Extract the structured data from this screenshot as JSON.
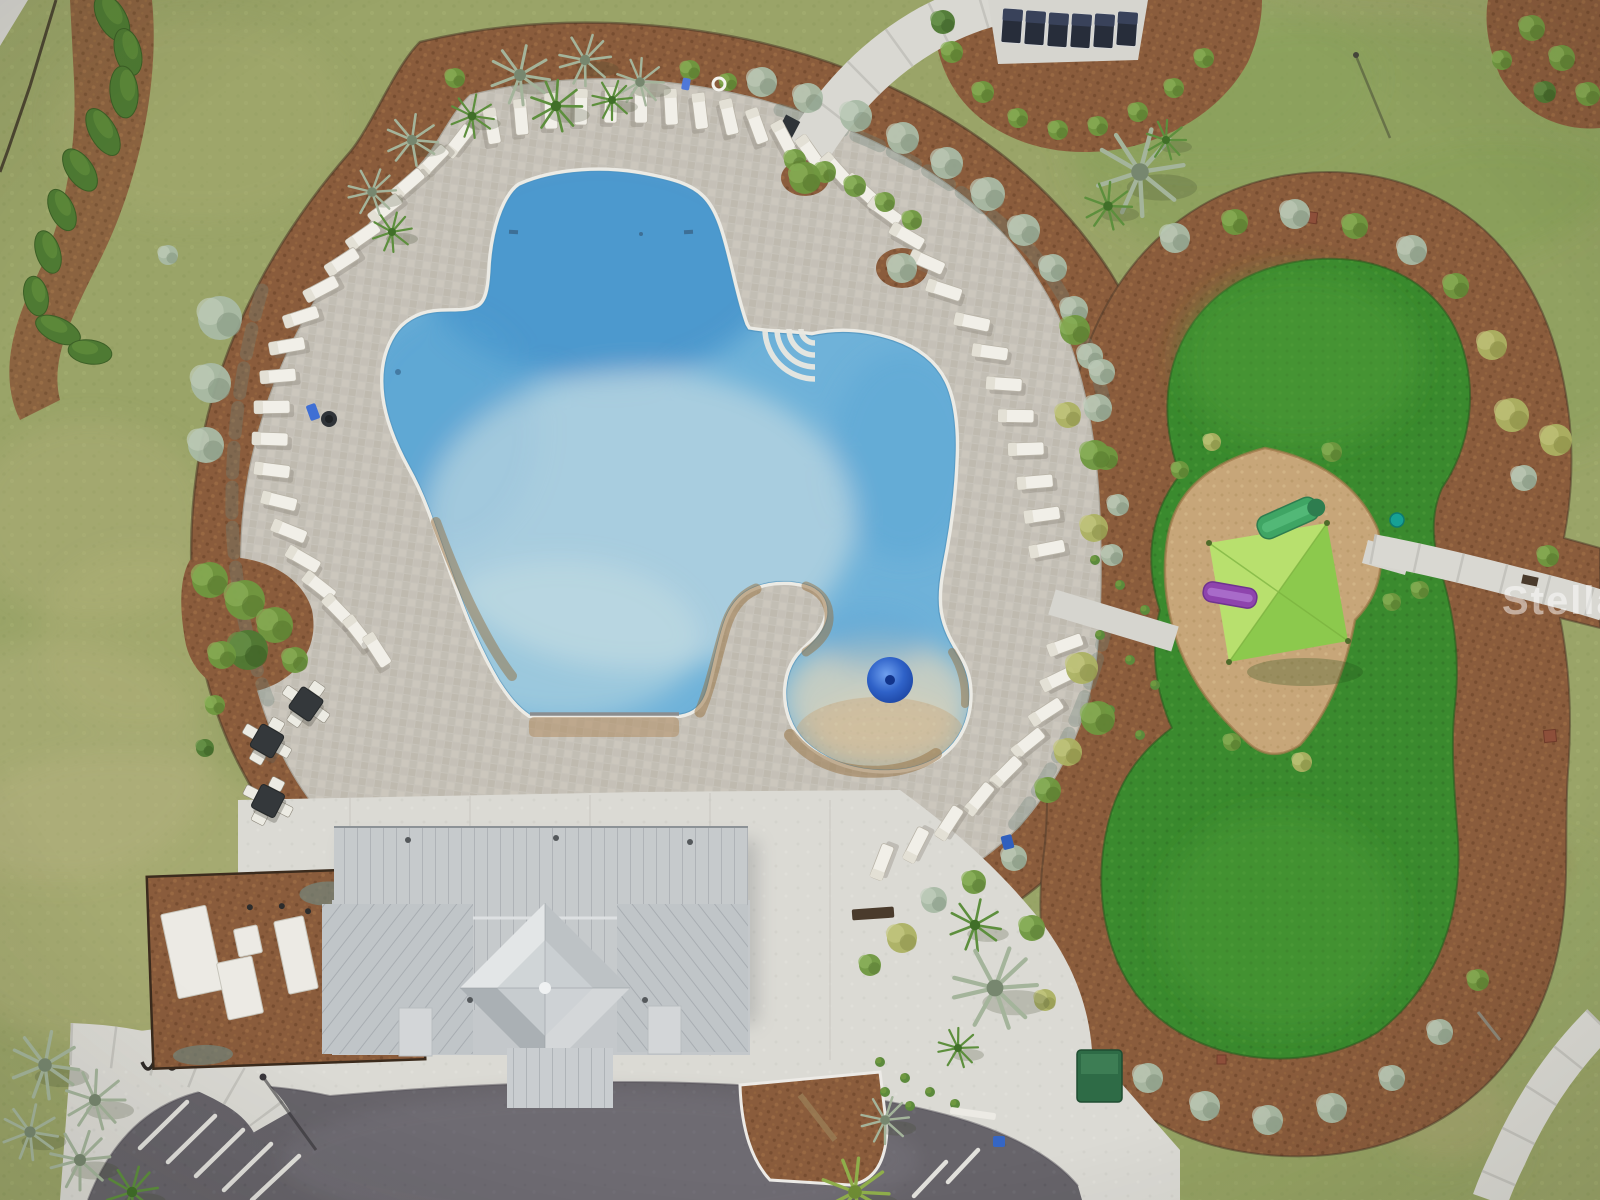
{
  "meta": {
    "description": "Aerial drone photograph of a community amenity center: free-form resort pool with lounge chairs, clubhouse with metal roof, drop-off circle, parking, and a playground with green turf and shade sail",
    "image_type": "aerial-photograph"
  },
  "watermark": {
    "text": "StellarMLS"
  },
  "palette": {
    "lawn": "#9aa468",
    "lawn_pale": "#bdb887",
    "lawn_rich": "#7f9d52",
    "mulch": "#8a5c3c",
    "mulch_dark": "#6e452b",
    "fence": "#3a2c1c",
    "deck": "#c7c3ba",
    "concrete": "#dbdad4",
    "asphalt": "#67646a",
    "water": "#6fb2d9",
    "water_deep": "#3d92cc",
    "water_pale": "#c3dce3",
    "coping": "#ecebe5",
    "lagoon_sand": "#d8cfb4",
    "splash_dome": "#2f62c8",
    "turf": "#3a8a2e",
    "turf_dark": "#2e6d24",
    "sand": "#c7a679",
    "sail_light": "#b8e06e",
    "sail_dark": "#8cc94d",
    "slide_purple": "#8e44ad",
    "slide_green": "#3fa564",
    "teal": "#16a195",
    "lounger": "#f1efe8",
    "cabana_chair": "#272d3a",
    "roof": "#c6cacc",
    "roof_dark": "#b5babd",
    "shrub_silver": "#a9bba6",
    "shrub_green": "#6f9840",
    "shrub_dark": "#4e7a33",
    "shrub_yellow": "#acb263",
    "palm_silver": "#a4b49b",
    "palm_green": "#5d8f3d"
  },
  "counts": {
    "lounge_chairs": 55,
    "cabana_loungers": 6,
    "dining_tables": 3,
    "parking_stripes": 7,
    "equipment_pads": 4
  },
  "scene": {
    "loungers": [
      [
        492,
        126,
        80
      ],
      [
        521,
        117,
        85
      ],
      [
        551,
        111,
        89
      ],
      [
        581,
        107,
        91
      ],
      [
        611,
        105,
        92
      ],
      [
        641,
        105,
        90
      ],
      [
        671,
        107,
        87
      ],
      [
        700,
        111,
        83
      ],
      [
        729,
        117,
        77
      ],
      [
        757,
        126,
        70
      ],
      [
        784,
        138,
        62
      ],
      [
        810,
        152,
        55
      ],
      [
        836,
        169,
        48
      ],
      [
        861,
        189,
        42
      ],
      [
        885,
        211,
        36
      ],
      [
        907,
        236,
        30
      ],
      [
        927,
        262,
        24
      ],
      [
        944,
        290,
        18
      ],
      [
        972,
        322,
        12
      ],
      [
        990,
        352,
        8
      ],
      [
        1004,
        384,
        4
      ],
      [
        1016,
        416,
        1
      ],
      [
        1026,
        449,
        -2
      ],
      [
        1035,
        482,
        -5
      ],
      [
        1042,
        515,
        -8
      ],
      [
        1047,
        549,
        -11
      ],
      [
        1065,
        645,
        -20
      ],
      [
        1058,
        679,
        -26
      ],
      [
        1046,
        712,
        -33
      ],
      [
        1028,
        743,
        -39
      ],
      [
        1006,
        772,
        -45
      ],
      [
        979,
        799,
        -51
      ],
      [
        949,
        823,
        -57
      ],
      [
        916,
        845,
        -63
      ],
      [
        882,
        862,
        -69
      ],
      [
        459,
        141,
        -52
      ],
      [
        433,
        161,
        -46
      ],
      [
        408,
        184,
        -41
      ],
      [
        385,
        209,
        -38
      ],
      [
        363,
        236,
        -35
      ],
      [
        342,
        262,
        -33
      ],
      [
        321,
        289,
        -28
      ],
      [
        301,
        317,
        -18
      ],
      [
        287,
        346,
        -10
      ],
      [
        278,
        376,
        -5
      ],
      [
        272,
        407,
        -1
      ],
      [
        270,
        439,
        2
      ],
      [
        272,
        470,
        7
      ],
      [
        279,
        501,
        14
      ],
      [
        289,
        531,
        22
      ],
      [
        303,
        559,
        30
      ],
      [
        319,
        586,
        38
      ],
      [
        338,
        610,
        46
      ],
      [
        358,
        632,
        52
      ],
      [
        377,
        650,
        57
      ]
    ],
    "cabana_loungers": [
      [
        1012,
        26
      ],
      [
        1035,
        28
      ],
      [
        1058,
        30
      ],
      [
        1081,
        31
      ],
      [
        1104,
        31
      ],
      [
        1127,
        29
      ]
    ],
    "tables": [
      [
        306,
        704,
        35
      ],
      [
        267,
        741,
        30
      ],
      [
        268,
        801,
        27
      ]
    ],
    "parking_stripes": [
      [
        168,
        1162,
        215,
        1116
      ],
      [
        196,
        1176,
        243,
        1130
      ],
      [
        224,
        1190,
        271,
        1144
      ],
      [
        252,
        1200,
        299,
        1156
      ],
      [
        140,
        1148,
        187,
        1102
      ],
      [
        948,
        1182,
        978,
        1150
      ],
      [
        914,
        1196,
        946,
        1162
      ]
    ],
    "equipment_pads": [
      [
        192,
        952,
        46,
        86,
        -12
      ],
      [
        248,
        941,
        24,
        28,
        -12
      ],
      [
        240,
        988,
        36,
        58,
        -12
      ],
      [
        296,
        955,
        30,
        74,
        -12
      ]
    ],
    "hedges": [
      [
        112,
        18,
        26,
        14,
        60
      ],
      [
        128,
        52,
        24,
        13,
        75
      ],
      [
        124,
        92,
        26,
        14,
        85
      ],
      [
        103,
        132,
        26,
        13,
        60
      ],
      [
        80,
        170,
        24,
        13,
        55
      ],
      [
        62,
        210,
        22,
        12,
        65
      ],
      [
        48,
        252,
        22,
        12,
        72
      ],
      [
        36,
        296,
        20,
        12,
        78
      ],
      [
        58,
        330,
        24,
        12,
        25
      ],
      [
        90,
        352,
        22,
        12,
        8
      ]
    ],
    "shrubs": [
      [
        220,
        318,
        22,
        "silver"
      ],
      [
        211,
        383,
        20,
        "silver"
      ],
      [
        206,
        445,
        18,
        "silver"
      ],
      [
        168,
        255,
        10,
        "silver"
      ],
      [
        210,
        580,
        18,
        "green"
      ],
      [
        245,
        600,
        20,
        "green"
      ],
      [
        275,
        625,
        18,
        "green"
      ],
      [
        248,
        650,
        20,
        "dark"
      ],
      [
        222,
        655,
        14,
        "green"
      ],
      [
        295,
        660,
        13,
        "green"
      ],
      [
        215,
        705,
        10,
        "green"
      ],
      [
        205,
        748,
        9,
        "dark"
      ],
      [
        455,
        78,
        10,
        "green"
      ],
      [
        690,
        70,
        10,
        "green"
      ],
      [
        728,
        82,
        9,
        "green"
      ],
      [
        762,
        82,
        15,
        "silver"
      ],
      [
        808,
        98,
        15,
        "silver"
      ],
      [
        856,
        116,
        16,
        "silver"
      ],
      [
        903,
        138,
        16,
        "silver"
      ],
      [
        947,
        163,
        16,
        "silver"
      ],
      [
        988,
        194,
        17,
        "silver"
      ],
      [
        1024,
        230,
        16,
        "silver"
      ],
      [
        1053,
        268,
        14,
        "silver"
      ],
      [
        1074,
        310,
        14,
        "silver"
      ],
      [
        1090,
        356,
        13,
        "silver"
      ],
      [
        795,
        160,
        11,
        "green"
      ],
      [
        825,
        172,
        11,
        "green"
      ],
      [
        855,
        186,
        11,
        "green"
      ],
      [
        885,
        202,
        10,
        "green"
      ],
      [
        912,
        220,
        10,
        "green"
      ],
      [
        805,
        178,
        16,
        "green"
      ],
      [
        902,
        268,
        15,
        "silver"
      ],
      [
        1098,
        408,
        14,
        "silver"
      ],
      [
        1106,
        458,
        12,
        "green"
      ],
      [
        1094,
        528,
        14,
        "yellow"
      ],
      [
        1112,
        555,
        11,
        "silver"
      ],
      [
        1082,
        668,
        16,
        "yellow"
      ],
      [
        1098,
        718,
        17,
        "green"
      ],
      [
        1068,
        752,
        14,
        "yellow"
      ],
      [
        1048,
        790,
        13,
        "green"
      ],
      [
        1014,
        858,
        13,
        "silver"
      ],
      [
        974,
        882,
        12,
        "green"
      ],
      [
        934,
        900,
        13,
        "silver"
      ],
      [
        902,
        938,
        15,
        "yellow"
      ],
      [
        1032,
        928,
        13,
        "green"
      ],
      [
        1045,
        1000,
        11,
        "yellow"
      ],
      [
        870,
        965,
        11,
        "green"
      ],
      [
        952,
        52,
        11,
        "green"
      ],
      [
        983,
        92,
        11,
        "green"
      ],
      [
        1018,
        118,
        10,
        "green"
      ],
      [
        1058,
        130,
        10,
        "green"
      ],
      [
        1098,
        126,
        10,
        "green"
      ],
      [
        1138,
        112,
        10,
        "green"
      ],
      [
        1174,
        88,
        10,
        "green"
      ],
      [
        1204,
        58,
        10,
        "green"
      ],
      [
        943,
        22,
        12,
        "dark"
      ],
      [
        1532,
        28,
        13,
        "green"
      ],
      [
        1562,
        58,
        13,
        "green"
      ],
      [
        1588,
        94,
        12,
        "green"
      ],
      [
        1545,
        92,
        11,
        "dark"
      ],
      [
        1502,
        60,
        10,
        "green"
      ],
      [
        1175,
        238,
        15,
        "silver"
      ],
      [
        1235,
        222,
        13,
        "green"
      ],
      [
        1295,
        214,
        15,
        "silver"
      ],
      [
        1355,
        226,
        13,
        "green"
      ],
      [
        1412,
        250,
        15,
        "silver"
      ],
      [
        1456,
        286,
        13,
        "green"
      ],
      [
        1492,
        345,
        15,
        "yellow"
      ],
      [
        1512,
        415,
        17,
        "yellow"
      ],
      [
        1524,
        478,
        13,
        "silver"
      ],
      [
        1548,
        556,
        11,
        "green"
      ],
      [
        1556,
        440,
        16,
        "yellow"
      ],
      [
        1075,
        330,
        15,
        "green"
      ],
      [
        1102,
        372,
        13,
        "silver"
      ],
      [
        1068,
        415,
        13,
        "yellow"
      ],
      [
        1095,
        455,
        15,
        "green"
      ],
      [
        1118,
        505,
        11,
        "silver"
      ],
      [
        1148,
        1078,
        15,
        "silver"
      ],
      [
        1205,
        1106,
        15,
        "silver"
      ],
      [
        1268,
        1120,
        15,
        "silver"
      ],
      [
        1332,
        1108,
        15,
        "silver"
      ],
      [
        1392,
        1078,
        13,
        "silver"
      ],
      [
        1440,
        1032,
        13,
        "silver"
      ],
      [
        1478,
        980,
        11,
        "green"
      ],
      [
        1180,
        470,
        9,
        "green"
      ],
      [
        1212,
        442,
        9,
        "yellow"
      ],
      [
        1332,
        452,
        10,
        "green"
      ],
      [
        1392,
        602,
        9,
        "green"
      ],
      [
        1302,
        762,
        10,
        "yellow"
      ],
      [
        1232,
        742,
        9,
        "green"
      ],
      [
        1420,
        590,
        9,
        "green"
      ]
    ],
    "palms": [
      [
        520,
        75,
        30,
        "silver"
      ],
      [
        585,
        60,
        26,
        "silver"
      ],
      [
        640,
        82,
        24,
        "silver"
      ],
      [
        412,
        140,
        26,
        "silver"
      ],
      [
        372,
        192,
        24,
        "silver"
      ],
      [
        556,
        106,
        26,
        "green"
      ],
      [
        472,
        116,
        22,
        "green"
      ],
      [
        612,
        100,
        20,
        "green"
      ],
      [
        392,
        232,
        20,
        "green"
      ],
      [
        1140,
        172,
        44,
        "silver"
      ],
      [
        1108,
        206,
        24,
        "green"
      ],
      [
        1166,
        140,
        20,
        "green"
      ],
      [
        975,
        925,
        26,
        "green"
      ],
      [
        995,
        988,
        42,
        "silver"
      ],
      [
        958,
        1048,
        20,
        "green"
      ],
      [
        45,
        1065,
        34,
        "silver"
      ],
      [
        95,
        1100,
        30,
        "silver"
      ],
      [
        30,
        1132,
        28,
        "silver"
      ],
      [
        80,
        1160,
        30,
        "silver"
      ],
      [
        132,
        1192,
        26,
        "green"
      ],
      [
        855,
        1192,
        34,
        "yellowp"
      ],
      [
        885,
        1120,
        24,
        "silver"
      ]
    ],
    "tufts": [
      [
        1095,
        560
      ],
      [
        1120,
        585
      ],
      [
        1145,
        610
      ],
      [
        1100,
        635
      ],
      [
        1130,
        660
      ],
      [
        1155,
        685
      ],
      [
        1110,
        710
      ],
      [
        1140,
        735
      ],
      [
        880,
        1062
      ],
      [
        905,
        1078
      ],
      [
        930,
        1092
      ],
      [
        955,
        1104
      ],
      [
        885,
        1092
      ],
      [
        910,
        1106
      ]
    ],
    "grass_patches": [
      [
        120,
        900,
        200,
        150,
        "#bdb887",
        0.32
      ],
      [
        60,
        760,
        150,
        120,
        "#bdb887",
        0.28
      ],
      [
        90,
        520,
        120,
        100,
        "#b9b480",
        0.28
      ],
      [
        140,
        640,
        100,
        90,
        "#b9b480",
        0.22
      ],
      [
        200,
        120,
        150,
        100,
        "#a8ab74",
        0.3
      ],
      [
        1350,
        150,
        280,
        130,
        "#7f9d52",
        0.38
      ],
      [
        1500,
        300,
        200,
        160,
        "#7f9d52",
        0.32
      ],
      [
        1200,
        80,
        180,
        90,
        "#86a258",
        0.3
      ],
      [
        1300,
        1150,
        220,
        90,
        "#8aa05c",
        0.3
      ],
      [
        1500,
        950,
        150,
        120,
        "#90a763",
        0.25
      ],
      [
        1150,
        950,
        200,
        150,
        "#93a565",
        0.28
      ],
      [
        1450,
        1120,
        60,
        40,
        "#b3ab79",
        0.4
      ],
      [
        1488,
        1022,
        26,
        20,
        "#8a5c3c",
        0.75
      ],
      [
        1545,
        865,
        20,
        14,
        "#96704a",
        0.7
      ]
    ]
  }
}
